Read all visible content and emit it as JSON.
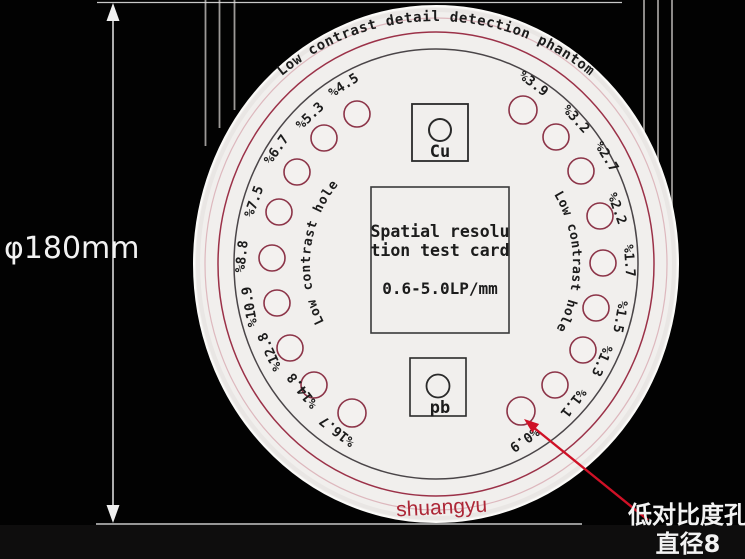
{
  "dimension": {
    "label": "φ180mm"
  },
  "callout": {
    "line1": "低对比度孔",
    "line2": "直径8"
  },
  "watermark": "shuangyu",
  "disc": {
    "title": "Low contrast detail detection phantom",
    "left_arc": "Low contrast hole",
    "right_arc": "Low contrast hole",
    "card": {
      "line1": "Spatial resolu",
      "line2": "tion test card",
      "line3": "0.6-5.0LP/mm"
    },
    "cu_label": "Cu",
    "pb_label": "pb",
    "left_holes": [
      {
        "label": "%4.5"
      },
      {
        "label": "%5.3"
      },
      {
        "label": "%6.7"
      },
      {
        "label": "%7.5"
      },
      {
        "label": "%8.8"
      },
      {
        "label": "%10.9"
      },
      {
        "label": "%12.8"
      },
      {
        "label": "%14.8"
      },
      {
        "label": "%16.7"
      }
    ],
    "right_holes": [
      {
        "label": "%3.9"
      },
      {
        "label": "%3.2"
      },
      {
        "label": "%2.7"
      },
      {
        "label": "%2.2"
      },
      {
        "label": "%1.7"
      },
      {
        "label": "%1.5"
      },
      {
        "label": "%1.3"
      },
      {
        "label": "%1.1"
      },
      {
        "label": "%0.9"
      }
    ]
  },
  "colors": {
    "background": "#020202",
    "disc": "#f1efed",
    "ring_red": "#9b3148",
    "ring_pink": "#d8aab2",
    "ring_dark": "#4a4548",
    "hole_stroke": "#8c3448",
    "ink": "#1c1c1c",
    "watermark_red": "#ad2737",
    "arrow_red": "#cf1126",
    "annotation_white": "#f2f2f2"
  }
}
